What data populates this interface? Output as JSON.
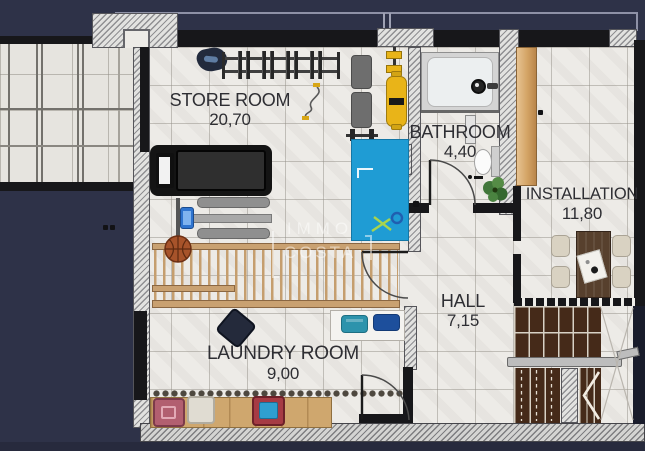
{
  "watermark": {
    "line1": "IMMO",
    "line2": "COSTA"
  },
  "rooms": {
    "store_room": {
      "name": "STORE ROOM",
      "area": "20,70"
    },
    "bathroom": {
      "name": "BATHROOM",
      "area": "4,40"
    },
    "installation": {
      "name": "INSTALLATION",
      "area": "11,80"
    },
    "hall": {
      "name": "HALL",
      "area": "7,15"
    },
    "laundry_room": {
      "name": "LAUNDRY ROOM",
      "area": "9,00"
    }
  },
  "colors": {
    "background": "#2e3248",
    "floor": "#edebe7",
    "wall": "#17171a",
    "mat_blue": "#1f9cd4",
    "wood_light": "#cfa76e",
    "stair_wood": "#452a19",
    "accent_yellow": "#e9b418"
  }
}
